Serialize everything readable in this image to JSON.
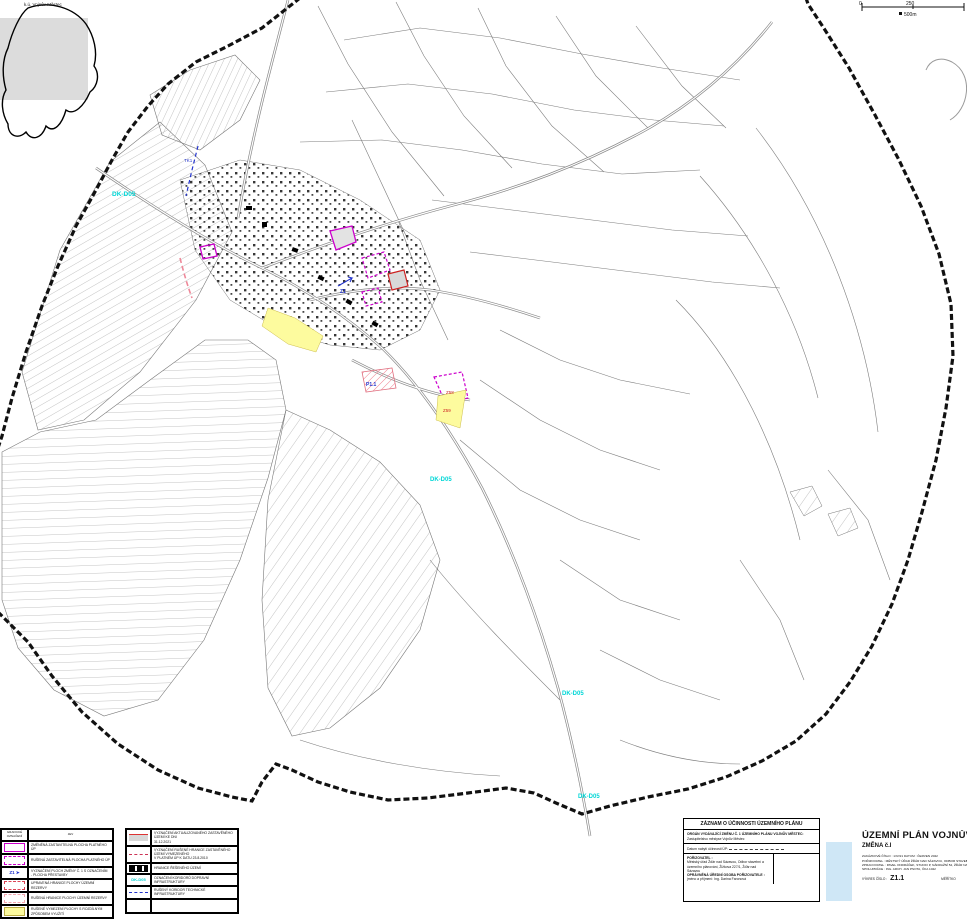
{
  "inset": {
    "label": "k.ú. Vojnův Městec"
  },
  "scalebar": {
    "zero": "0",
    "mid": "250",
    "unit": "500m"
  },
  "map_labels": {
    "corridor_nw": "DK-D05",
    "corridor_mid": "DK-D05",
    "corridor_s1": "DK-D05",
    "corridor_s2": "DK-D05",
    "zone_z58": "Z58",
    "zone_z59": "Z59",
    "zone_p1": "P1.1",
    "zone_z1": "Z1",
    "tech_corridor": "TK1"
  },
  "legend_left": {
    "header_col1": "grafické\noznačení",
    "header_col2": "jev",
    "items": [
      {
        "swatch": "magenta-solid",
        "label": "ZMĚNĚNÁ ZASTAVITELNÁ PLOCHA PLATNÉHO ÚP"
      },
      {
        "swatch": "magenta-dashed",
        "label": "RUŠENÁ ZASTAVITELNÁ PLOCHA PLATNÉHO ÚP"
      },
      {
        "swatch": "blue-arrow",
        "text": "Z1 ➤",
        "label": "VYZNAČENÍ PLOCH ZMĚNY Č. 1 S OZNAČENÍM\n- PLOCHA PŘESTAVBY"
      },
      {
        "swatch": "red-dashed",
        "label": "UPRAVENÁ HRANICE PLOCHY ÚZEMNÍ REZERVY"
      },
      {
        "swatch": "red-dashed-light",
        "label": "RUŠENÁ HRANICE PLOCHY ÚZEMNÍ REZERVY"
      },
      {
        "swatch": "yellow-fill",
        "label": "RUŠENÉ VYMEZENÍ PLOCHY S ROZDÍLNÝM ZPŮSOBEM VYUŽITÍ"
      }
    ]
  },
  "legend_right": {
    "items": [
      {
        "swatch": "gray-red",
        "label": "VYZNAČENÍ AKTUALIZOVANÉHO ZASTAVĚNÉHO ÚZEMÍ KE DNI\n31.12.2021"
      },
      {
        "swatch": "line-only",
        "label": "VYZNAČENÍ RUŠENÉ HRANICE ZASTAVĚNÉHO ÚZEMÍ VYMEZENÉHO\nV PLATNÉM ÚP K DATU 23.8.2010"
      },
      {
        "swatch": "black-band",
        "label": "HRANICE ŘEŠENÉHO ÚZEMÍ"
      },
      {
        "swatch": "cyan-label",
        "text": "DK-D05",
        "label": "OZNAČENÍ KORIDORŮ DOPRAVNÍ INFRASTRUKTURY"
      },
      {
        "swatch": "blue-dash",
        "label": "RUŠENÝ KORIDOR TECHNICKÉ INFRASTRUKTURY"
      }
    ]
  },
  "record_box": {
    "title": "ZÁZNAM O ÚČINNOSTI ÚZEMNÍHO PLÁNU",
    "issuer_label": "ORGÁN VYDÁVAJÍCÍ ZMĚNU Č. 1 ÚZEMNÍHO PLÁNU VOJNŮV MĚSTEC:",
    "issuer_value": "Zastupitelstvo městyse Vojnův Městec",
    "effective_label": "Datum nabytí účinnosti ÚP:",
    "buyer_label": "POŘIZOVATEL :",
    "buyer_value": "Městský úřad Žďár nad Sázavou, Odbor stavební a územního plánování, Žižkova 227/1, Žďár nad Sázavou",
    "person_label": "OPRÁVNĚNÁ ÚŘEDNÍ OSOBA POŘIZOVATELE :",
    "person_value": "jméno a příjmení: Ing. Darina Faronová"
  },
  "title_block": {
    "title": "ÚZEMNÍ PLÁN VOJNŮV MĚSTEC",
    "subtitle": "ZMĚNA č.I",
    "order_row": "ZAKÁZKOVÉ ČÍSLO : 1/IV/21          DATUM : ČERVEN 2022",
    "buyer_row": "POŘIZOVATEL : MĚSTSKÝ ÚŘAD ŽĎÁR NAD SÁZAVOU, ODBOR STAVEBNÍ A ÚZEMNÍHO PLÁNOVÁNÍ",
    "author_row": "ZPRACOVATEL : PAVEL ONDRÁČEK, STUDIO P, NÁDRAŽNÍ 52, ŽĎÁR NAD SÁZAVOU",
    "coop_row": "SPOLUPRÁCE : ING. ARCH. JAN PSOTA, ČKA 1042",
    "drawing_label": "VÝKRES ČÍSLO :",
    "drawing_number": "Z1.1",
    "scale_label": "MĚŘÍTKO"
  }
}
